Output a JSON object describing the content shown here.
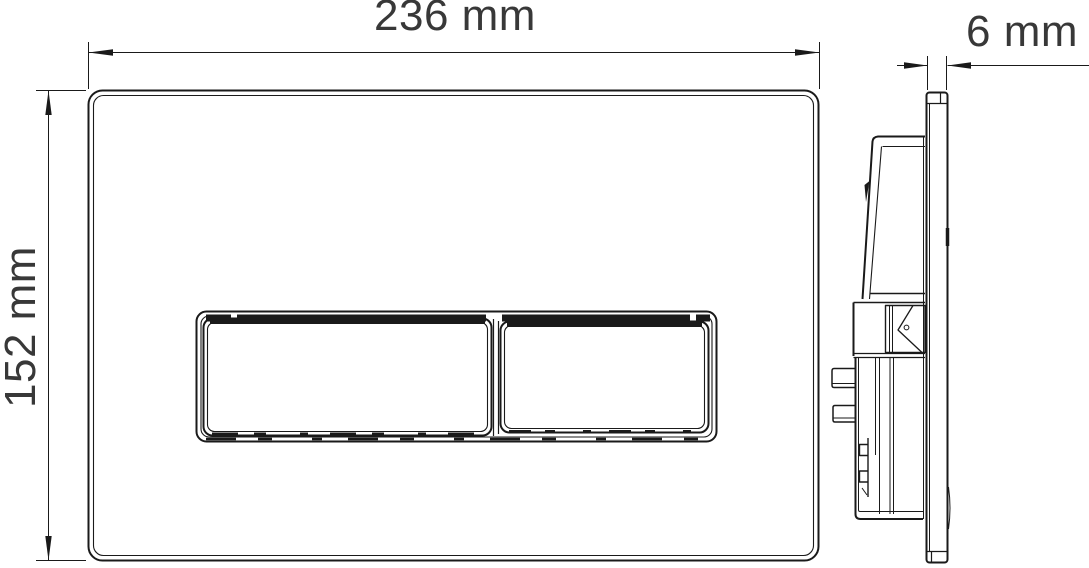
{
  "drawing": {
    "labels": {
      "width": "236 mm",
      "height": "152 mm",
      "depth": "6 mm"
    },
    "values": {
      "width_mm": 236,
      "height_mm": 152,
      "depth_mm": 6
    },
    "colors": {
      "line": "#1a1a1a",
      "dimension_text": "#383838",
      "background": "#ffffff"
    }
  }
}
